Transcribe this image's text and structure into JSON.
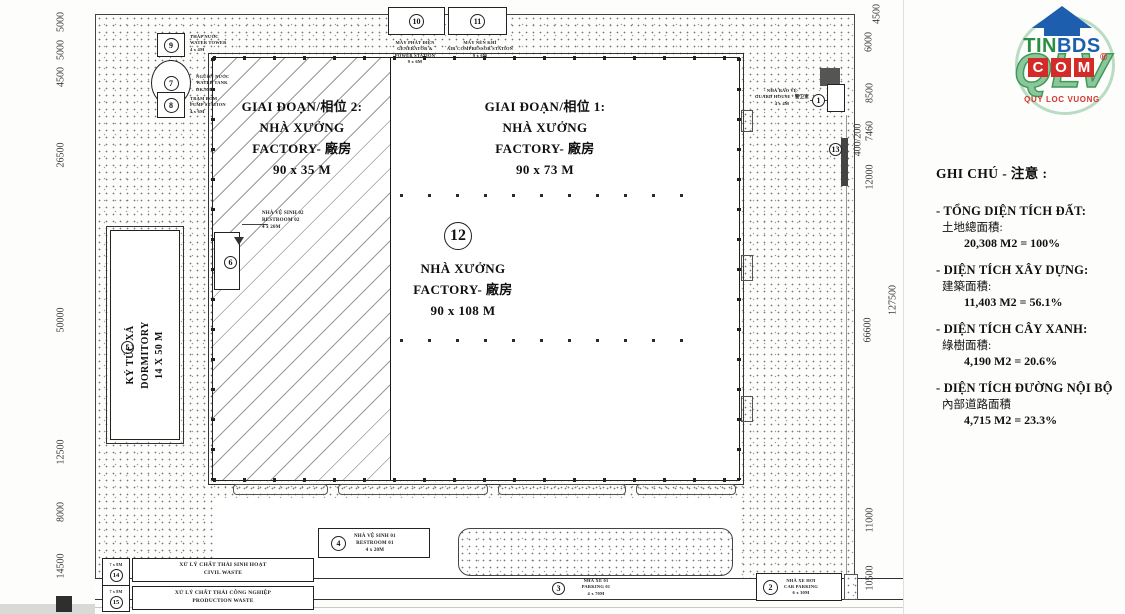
{
  "logo": {
    "brand_top_green": "TIN",
    "brand_top_blue": "BDS",
    "brand_mid": [
      "C",
      "O",
      "M"
    ],
    "brand_watermark": "QLV",
    "registered_mark": "®",
    "tagline": "QUY LOC VUONG",
    "colors": {
      "house_blue": "#1d5fae",
      "tin_green": "#2a8f43",
      "com_red": "#d42a28",
      "qlv_green": "#3f9a58",
      "ring_green": "#b9dcc3",
      "tagline_red": "#d4372e"
    }
  },
  "legend": {
    "title": "GHI CHÚ - 注意 :",
    "items": [
      {
        "vi": "- TỔNG DIỆN TÍCH ĐẤT:",
        "cn": "土地總面積:",
        "value": "20,308 M2 = 100%"
      },
      {
        "vi": "- DIỆN TÍCH XÂY DỰNG:",
        "cn": "建築面積:",
        "value": "11,403 M2 = 56.1%"
      },
      {
        "vi": "- DIỆN TÍCH CÂY XANH:",
        "cn": "綠樹面積:",
        "value": "4,190 M2 = 20.6%"
      },
      {
        "vi": "- DIỆN TÍCH ĐƯỜNG NỘI BỘ",
        "cn": "內部道路面積",
        "value": "4,715 M2 = 23.3%"
      }
    ]
  },
  "plan": {
    "phase2_label": {
      "l1": "GIAI ĐOẠN/相位  2:",
      "l2": "NHÀ XƯỞNG",
      "l3": "FACTORY- 廠房",
      "l4": "90 x 35 M"
    },
    "phase1_label": {
      "l1": "GIAI ĐOẠN/相位  1:",
      "l2": "NHÀ XƯỞNG",
      "l3": "FACTORY- 廠房",
      "l4": "90 x 73 M"
    },
    "factory_label": {
      "callout": "12",
      "l1": "NHÀ XƯỞNG",
      "l2": "FACTORY- 廠房",
      "l3": "90 x 108 M"
    },
    "dormitory": {
      "callout": "5",
      "l1": "KÝ TÚC XÁ",
      "l2": "DORMITORY",
      "l3": "14 X 50 M"
    },
    "guard_house": {
      "callout": "1",
      "l1": "NHÀ BẢO VỆ",
      "l2": "GUARD HOUSE - 警卫室",
      "l3": "4 x 4M"
    },
    "restroom1": {
      "callout": "4",
      "l1": "NHÀ VỆ SINH 01",
      "l2": "RESTROOM 01",
      "l3": "4 x 20M"
    },
    "restroom2": {
      "callout": "6",
      "l1": "NHÀ VỆ SINH 02",
      "l2": "RESTROOM 02",
      "l3": "4 x 20M"
    },
    "parking1": {
      "callout": "3",
      "l1": "NHÀ XE 01",
      "l2": "PARKING 01",
      "l3": "4 x 70M"
    },
    "car_parking": {
      "callout": "2",
      "l1": "NHÀ XE HƠI",
      "l2": "CAR PARKING",
      "l3": "6 x 30M"
    },
    "water_tower": {
      "callout": "9",
      "l1": "THÁP NƯỚC",
      "l2": "WATER TOWER",
      "l3": "4 x 4M"
    },
    "water_tank": {
      "callout": "7",
      "l1": "NGUỒN NƯỚC",
      "l2": "WATER TANK",
      "l3": "DK 9M"
    },
    "pump_station": {
      "callout": "8",
      "l1": "TRẠM BƠM",
      "l2": "PUMP STATION",
      "l3": "4 x 6M"
    },
    "generator": {
      "callout": "10",
      "l1": "MÁY PHÁT ĐIỆN",
      "l2": "GENERATOR &",
      "l3": "POWER STATION",
      "l4": "9 x 6M"
    },
    "compressor": {
      "callout": "11",
      "l1": "MÁY NÉN KHÍ",
      "l2": "AIR COMPRESSOR STATION",
      "l3": "9 x 6M"
    },
    "civil_waste": {
      "callout": "14",
      "size": "7 x 8M",
      "l1": "XỬ LÝ CHẤT THẢI SINH HOẠT",
      "l2": "CIVIL WASTE"
    },
    "production_waste": {
      "callout": "15",
      "size": "7 x 8M",
      "l1": "XỬ LÝ CHẤT THẢI CÔNG NGHIỆP",
      "l2": "PRODUCTION WASTE"
    },
    "fence_callout": "13"
  },
  "dimensions": {
    "left": [
      "5000",
      "5000",
      "4500",
      "26500",
      "50000",
      "12500",
      "8000",
      "14500"
    ],
    "right_inner": [
      "4500",
      "6000",
      "8500",
      "7460",
      "12000",
      "66600",
      "11000",
      "10500"
    ],
    "guard_dim": "400/200",
    "right_outer": "127500"
  }
}
